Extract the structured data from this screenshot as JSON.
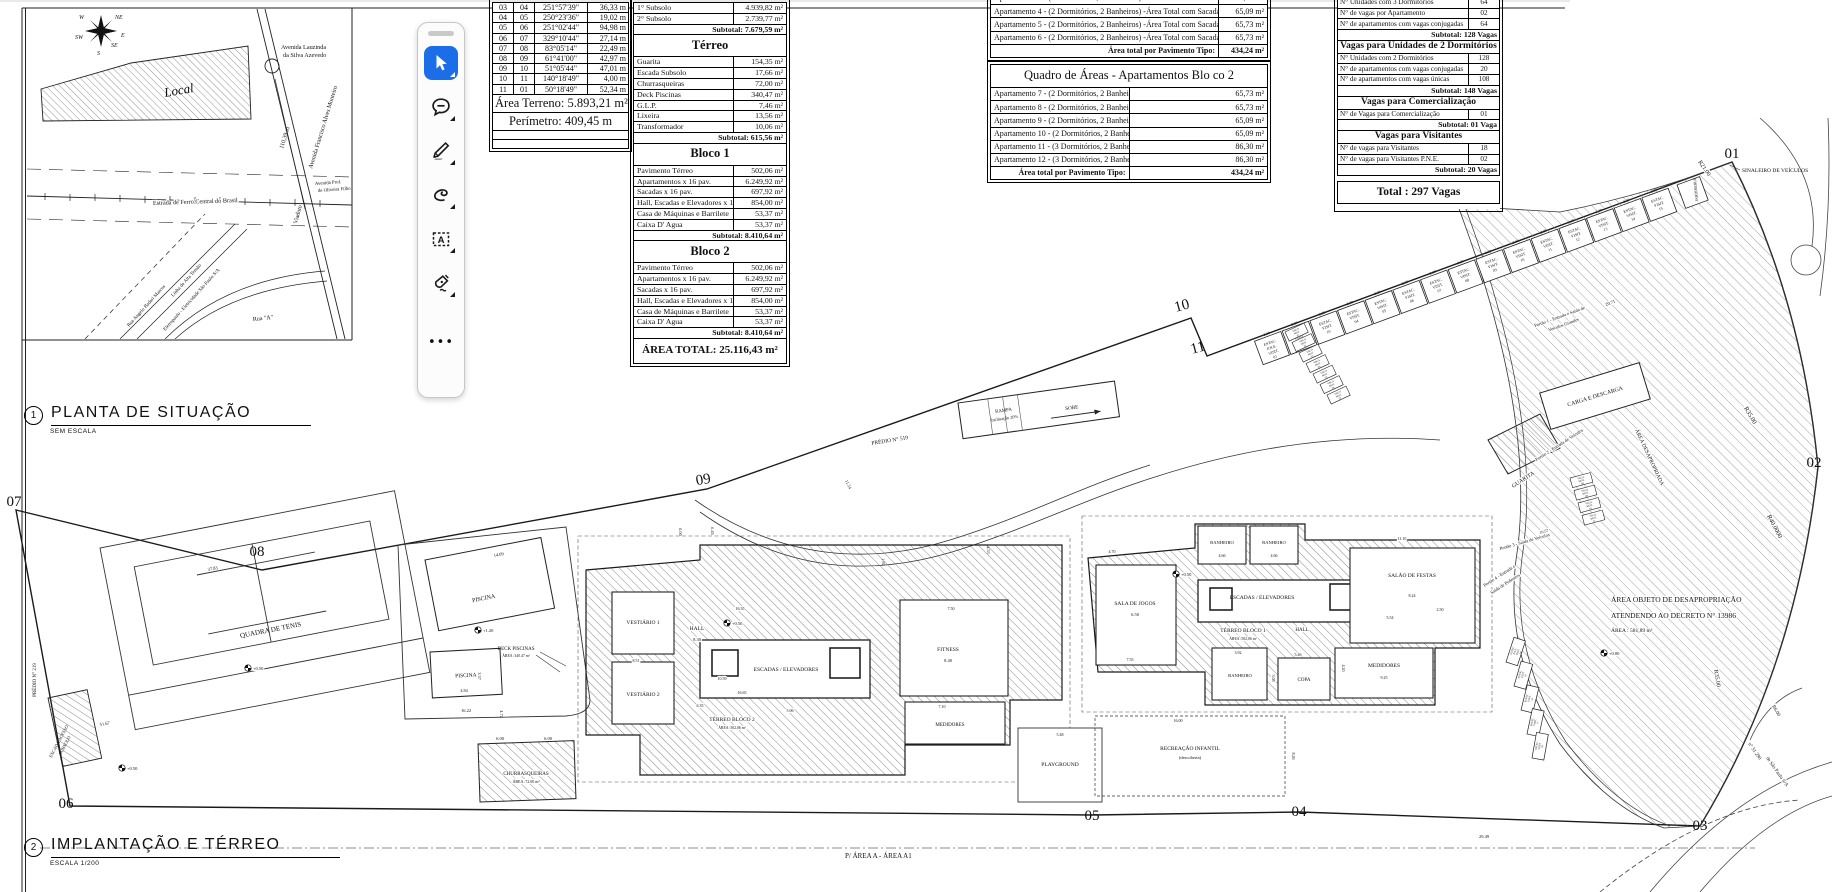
{
  "situation_map": {
    "section_number": "1",
    "title": "PLANTA DE SITUAÇÃO",
    "scale": "SEM ESCALA",
    "local": "Local",
    "compass": {
      "w": "W",
      "ne": "NE",
      "sw": "SW",
      "e": "E",
      "s": "S",
      "se": "SE"
    },
    "labels": {
      "lauzinda1": "Avenida Lauzinda",
      "lauzinda2": "da Silva Azevedo",
      "francisco": "Avenida Francisco Alves Monteiro",
      "dist": "110,39 m",
      "viaduto": "Viaduto",
      "ferro": "Estrada de Ferro Central do Brasil",
      "prof1": "Avenida Prof.",
      "prof2": "de Oliveira Filho",
      "ruaA": "Rua \"A\"",
      "badari": "Rua Angelo Badari Marcos",
      "alta": "Linha de Alta Tensão",
      "eletro": "Eletropaulo - Eletricidade São Paulo S/A"
    }
  },
  "toolbar": {
    "tools": [
      {
        "name": "select-tool",
        "selected": true
      },
      {
        "name": "comment-tool",
        "selected": false
      },
      {
        "name": "draw-tool",
        "selected": false
      },
      {
        "name": "lasso-tool",
        "selected": false
      },
      {
        "name": "text-box-tool",
        "selected": false
      },
      {
        "name": "signature-tool",
        "selected": false
      },
      {
        "name": "more-tools",
        "selected": false
      }
    ],
    "text_tool_letter": "A",
    "more_label": "•••",
    "accent_color": "#1b6ee8"
  },
  "survey_table": {
    "rows": [
      [
        "03",
        "04",
        "251°57'39\"",
        "36,33 m"
      ],
      [
        "04",
        "05",
        "250°23'36\"",
        "19,02 m"
      ],
      [
        "05",
        "06",
        "251°02'44\"",
        "94,98 m"
      ],
      [
        "06",
        "07",
        "329°10'44\"",
        "27,14 m"
      ],
      [
        "07",
        "08",
        "83°05'14\"",
        "22,49 m"
      ],
      [
        "08",
        "09",
        "61°41'00\"",
        "42,97 m"
      ],
      [
        "09",
        "10",
        "51°05'44\"",
        "47,01 m"
      ],
      [
        "10",
        "11",
        "140°18'49\"",
        "4,00 m"
      ],
      [
        "11",
        "01",
        "50°18'49\"",
        "52,34 m"
      ]
    ],
    "area_label": "Área Terreno: 5.893,21 m²",
    "perimeter_label": "Perímetro: 409,45 m"
  },
  "areas_table": {
    "rows": [
      {
        "label": "1° Subsolo",
        "value": "4.939,82 m²"
      },
      {
        "label": "2° Subsolo",
        "value": "2.739,77 m²"
      },
      {
        "type": "subtotal",
        "merge": true,
        "label": "Subtotal:  7.679,59 m²"
      },
      {
        "type": "header",
        "merge": true,
        "label": "Térreo"
      },
      {
        "label": "Guarita",
        "value": "154,35 m²"
      },
      {
        "label": "Escada Subsolo",
        "value": "17,66 m²"
      },
      {
        "label": "Churrasqueiras",
        "value": "72,00 m²"
      },
      {
        "label": "Deck Piscinas",
        "value": "340,47 m²"
      },
      {
        "label": "G.L.P.",
        "value": "7,46 m²"
      },
      {
        "label": "Lixeira",
        "value": "13,56 m²"
      },
      {
        "label": "Transformador",
        "value": "10,06 m²"
      },
      {
        "type": "subtotal",
        "merge": true,
        "label": "Subtotal:  615,56 m²"
      },
      {
        "type": "header",
        "merge": true,
        "label": "Bloco 1"
      },
      {
        "label": "Pavimento Térreo",
        "value": "502,06 m²"
      },
      {
        "label": "Apartamentos  x 16 pav.",
        "value": "6.249,92 m²"
      },
      {
        "label": "Sacadas  x 16 pav.",
        "value": "697,92 m²"
      },
      {
        "label": "Hall, Escadas e Elevadores x 16 pav.",
        "value": "854,00 m²"
      },
      {
        "label": "Casa de Máquinas e Barrilete",
        "value": "53,37 m²"
      },
      {
        "label": "Caixa D' Agua",
        "value": "53,37 m²"
      },
      {
        "type": "subtotal",
        "merge": true,
        "label": "Subtotal:  8.410,64 m²"
      },
      {
        "type": "header",
        "merge": true,
        "label": "Bloco 2"
      },
      {
        "label": "Pavimento Térreo",
        "value": "502,06 m²"
      },
      {
        "label": "Apartamentos  x 16 pav.",
        "value": "6.249,92 m²"
      },
      {
        "label": "Sacadas  x 16 pav.",
        "value": "697,92 m²"
      },
      {
        "label": "Hall, Escadas e Elevadores x 16 pav.",
        "value": "854,00 m²"
      },
      {
        "label": "Casa de Máquinas e Barrilete",
        "value": "53,37 m²"
      },
      {
        "label": "Caixa D' Agua",
        "value": "53,37 m²"
      },
      {
        "type": "subtotal",
        "merge": true,
        "label": "Subtotal:  8.410,64 m²"
      },
      {
        "type": "total",
        "merge": true,
        "label": "ÁREA TOTAL:  25.116,43 m²"
      }
    ]
  },
  "quadro_bloco1": {
    "rows": [
      {
        "label": "Apartamento 3 - (2 Dormitórios, 2 Banheiros) -Área Total com Sacada",
        "value": "65,09 m²"
      },
      {
        "label": "Apartamento 4 - (2 Dormitórios, 2 Banheiros) -Área Total com Sacada",
        "value": "65,09 m²"
      },
      {
        "label": "Apartamento 5 - (2 Dormitórios, 2 Banheiros) -Área Total com Sacada",
        "value": "65,73 m²"
      },
      {
        "label": "Apartamento 6 - (2 Dormitórios, 2 Banheiros) -Área Total com Sacada",
        "value": "65,73 m²"
      },
      {
        "type": "totalrow",
        "label": "Área total por Pavimento Tipo:",
        "value": "434,24 m²"
      }
    ]
  },
  "quadro_bloco2": {
    "title": "Quadro de Áreas - Apartamentos Bloco 2",
    "rows": [
      {
        "type": "title",
        "merge": true,
        "label": "Quadro de Áreas - Apartamentos Blo co 2"
      },
      {
        "label": "Apartamento 7 - (2 Dormitórios, 2 Banheiros) -Área Total com Sacada",
        "value": "65,73 m²"
      },
      {
        "label": "Apartamento 8 - (2 Dormitórios, 2 Banheiros) -Área Total com Sacada",
        "value": "65,73 m²"
      },
      {
        "label": "Apartamento 9 - (2 Dormitórios, 2 Banheiros) -Área Total com Sacada",
        "value": "65,09 m²"
      },
      {
        "label": "Apartamento 10 - (2 Dormitórios, 2 Banheiros) -Área Total com Sacada",
        "value": "65,09 m²"
      },
      {
        "label": "Apartamento 11 - (3 Dormitórios, 2 Banheiros) -Área Total com Sacada",
        "value": "86,30 m²"
      },
      {
        "label": "Apartamento 12 - (3 Dormitórios, 2 Banheiros) -Área Total com Sacada",
        "value": "86,30 m²"
      },
      {
        "type": "totalrow",
        "label": "Área total por Pavimento Tipo:",
        "value": "434,24 m²"
      }
    ]
  },
  "vagas_table": {
    "rows": [
      {
        "label": "N°  Unidades com 3 Dormitórios",
        "value": "64"
      },
      {
        "label": "N° de vagas por Apartamento",
        "value": "02"
      },
      {
        "label": "N° de apartamentos com vagas conjugadas",
        "value": "64"
      },
      {
        "type": "subtotal",
        "merge": true,
        "label": "Subtotal:  128 Vagas"
      },
      {
        "type": "header",
        "merge": true,
        "label": "Vagas para Unidades de  2 Dormitórios"
      },
      {
        "label": "N° Unidades com 2 Dormitórios",
        "value": "128"
      },
      {
        "label": "N° de apartamentos com vagas conjugadas",
        "value": "20"
      },
      {
        "label": "N° de apartamentos com vagas únicas",
        "value": "108"
      },
      {
        "type": "subtotal",
        "merge": true,
        "label": "Subtotal:  148 Vagas"
      },
      {
        "type": "header",
        "merge": true,
        "label": "Vagas para Comercialização"
      },
      {
        "label": "N° de Vagas para Comercialização",
        "value": "01"
      },
      {
        "type": "subtotal",
        "merge": true,
        "label": "Subtotal:  01 Vaga"
      },
      {
        "type": "header",
        "merge": true,
        "label": "Vagas para Visitantes"
      },
      {
        "label": "N°  de vagas para Visitantes",
        "value": "18"
      },
      {
        "label": "N°  de vagas para Visitantes P.N.E.",
        "value": "02"
      },
      {
        "type": "subtotal",
        "merge": true,
        "label": "Subtotal:  20 Vagas"
      },
      {
        "type": "spacer",
        "merge": true,
        "label": ""
      },
      {
        "type": "total",
        "merge": true,
        "label": "Total : 297 Vagas"
      },
      {
        "type": "spacer",
        "merge": true,
        "label": ""
      }
    ]
  },
  "site_plan": {
    "section_number": "2",
    "title": "IMPLANTAÇÃO E TÉRREO",
    "scale": "ESCALA 1/200",
    "footer_note": "P/ ÁREA A -  ÁREA A1",
    "vertices": [
      "01",
      "02",
      "03",
      "04",
      "05",
      "06",
      "07",
      "08",
      "09",
      "10",
      "11"
    ],
    "visitor_stalls": [
      "ESTAC. P.N.E. VISIT. 01",
      "ESTAC. VISIT. 02",
      "ESTAC. VISIT. 03",
      "ESTAC. VISIT. 04",
      "ESTAC. VISIT. 05",
      "ESTAC. VISIT. 06",
      "ESTAC. VISIT. 07",
      "ESTAC. VISIT. 08",
      "ESTAC. VISIT. 09",
      "ESTAC. VISIT. 10",
      "ESTAC. VISIT. 11",
      "ESTAC. VISIT. 12",
      "ESTAC. VISIT. 13",
      "ESTAC. VISIT. 14",
      "ESTAC. VISIT. 15"
    ],
    "curve_stalls": [
      "ESTAC. P.N.E. VISIT. 20",
      "ESTAC. VISIT. 19",
      "ESTAC. VISIT. 18",
      "ESTAC. VISIT. 17",
      "ESTAC. VISIT. 16"
    ],
    "moto_stalls_a": [
      "VAGA MOT. 01",
      "VAGA MOT. 02",
      "VAGA MOT. 03",
      "VAGA MOT. 04",
      "VAGA MOT. 05",
      "VAGA MOT. 06",
      "VAGA MOT. 07"
    ],
    "moto_stalls_b": [
      "VAGA MOT. 08",
      "VAGA MOT. 09",
      "VAGA MOT. 10",
      "VAGA MOT. 11"
    ],
    "levels": {
      "l000": "+0.00",
      "l050": "+0.50",
      "l120": "+1.20"
    },
    "labels": {
      "quadra": "QUADRA DE TENIS",
      "piscina": "PISCINA",
      "deck": "DECK PISCINAS",
      "deck_area": "ÁREA :340.47 m²",
      "churras": "CHURRASQUEIRAS",
      "churras_area": "ÁREA :72.00 m²",
      "vest1": "VESTIÁRIO 1",
      "vest2": "VESTIÁRIO 2",
      "hall": "HALL",
      "esc": "ESCADAS / ELEVADORES",
      "fitness": "FITNESS",
      "medidores": "MEDIDORES",
      "terreo2": "TÉRREO BLOCO  2",
      "terreo2_area": "ÁREA :502,06 m²",
      "terreo1": "TÉRREO BLOCO  1",
      "terreo1_area": "ÁREA :502,06 m²",
      "jogos": "SALA DE JOGOS",
      "banheiro": "BANHEIRO",
      "festas": "SALÃO DE FESTAS",
      "copa": "COPA",
      "playground": "PLAYGROUND",
      "recreacao": "RECREAÇÃO INFANTIL",
      "recreacao2": "(descoberta)",
      "rampa": "RAMPA",
      "rampa2": "Inclinação 20%",
      "sobe": "SOBE",
      "predio519": "PRÉDIO N° 519",
      "predio219": "PRÉDIO N° 219",
      "escada1": "ESCADA ACESSO",
      "escada2": "SUBSOLO",
      "guarita": "GUARITA",
      "carga": "CARGA E DESCARGA",
      "portao1": "Portão 1 - Entrada e Saída de",
      "portao1b": "Veículos Grandes",
      "portao2": "Portão 2 - Entrada  de Veículos",
      "portao3": "Portão 3 - Saída  de Veículos",
      "portao4": "Portão 4 - Entrada e",
      "portao4b": "Saída de Pedestres",
      "sinaleiro": "SINALEIRO DE VEÍCULOS",
      "jardineira": "JARDINEIRA",
      "desap1": "ÁREA OBJETO DE DESAPROPRIAÇÃO",
      "desap2": "ATENDENDO AO  DECRETO N° 13986",
      "desap3": "ÁREA : 581,89 m²",
      "area_desap": "ÁREA DESAPROPRIADA",
      "r21": "R21.00",
      "r35": "R35.00",
      "r40": "R40.0000",
      "r35b": "R35.00",
      "r6": "R6.00",
      "reg1": "n° 51.290",
      "reg2": "de São Paulo S/A"
    },
    "dims": {
      "t3783": "37.83",
      "p1409": "14.09",
      "p484": "4.84",
      "p337": "3.37",
      "d1622": "16.22",
      "d472": "4.72",
      "h830": "8.30",
      "f840": "8.40",
      "b2_1635": "16.35",
      "b2_750": "7.50",
      "b2_710": "7.10",
      "b2_851": "8.51",
      "b2_635": "6.35",
      "b2_506": "5.06",
      "b2_1059": "10.59",
      "b2_1665": "16.65",
      "j650": "6.50",
      "j755": "7.55",
      "j470": "4.70",
      "wc466": "4.66",
      "sf1110": "11.10",
      "sf824": "8.24",
      "sf554": "5.54",
      "sf250": "2.50",
      "cp546": "5.46",
      "cp308": "3.08",
      "md925": "9.25",
      "md420": "4.20",
      "bn392": "3.92",
      "rc1600": "16.00",
      "rc826": "8.26",
      "pg548": "5.48",
      "g2071": "20.71",
      "b2949": "29.49",
      "c1154": "11.54",
      "c192": "1.92",
      "c453": "4.53",
      "c600": "6.00",
      "c645": "6.45",
      "bl5167": "51.67",
      "st230": "2.30",
      "p1057": "10.57",
      "churr600": "6.00"
    }
  }
}
